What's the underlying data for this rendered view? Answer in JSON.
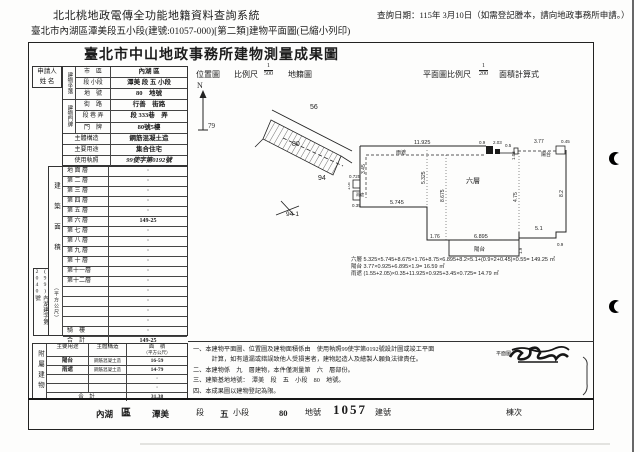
{
  "app": {
    "system_title": "北北桃地政電傳全功能地籍資料查詢系統",
    "query_date": "查詢日期：115年 3月10日（如需登記謄本，請向地政事務所申請。）",
    "subtitle": "臺北市內湖區潭美段五小段(建號:01057-000)[第二類]建物平面圖(已縮小列印)"
  },
  "doc": {
    "title": "臺北市中山地政事務所建物測量成果圖"
  },
  "form": {
    "applicant_line1": "申請人",
    "applicant_line2": "姓 名",
    "section_location": "建物坐落",
    "section_address": "建物門牌",
    "top_rows": [
      {
        "label": "市　區",
        "value": "內湖 區"
      },
      {
        "label": "段 小段",
        "value": "潭美 段 五 小段"
      },
      {
        "label": "地　號",
        "value": "80　地號"
      },
      {
        "label": "街　路",
        "value": "行善　街路"
      },
      {
        "label": "段 巷 弄",
        "value": "段 333巷　弄"
      },
      {
        "label": "門　牌",
        "value": "80號5樓"
      },
      {
        "label": "主體構造",
        "value": "鋼筋混凝土造"
      },
      {
        "label": "主要用途",
        "value": "集合住宅"
      },
      {
        "label": "使用執照",
        "value": "99使字第0192號"
      }
    ],
    "floor_area": {
      "side_label": "建築面積",
      "unit_label": "（平方公尺）",
      "rows": [
        {
          "label": "地 面 層",
          "value": "·"
        },
        {
          "label": "第 二 層",
          "value": "·"
        },
        {
          "label": "第 三 層",
          "value": "·"
        },
        {
          "label": "第 四 層",
          "value": "·"
        },
        {
          "label": "第 五 層",
          "value": "·"
        },
        {
          "label": "第 六 層",
          "value": "149-25"
        },
        {
          "label": "第 七 層",
          "value": "·"
        },
        {
          "label": "第 八 層",
          "value": "·"
        },
        {
          "label": "第 九 層",
          "value": "·"
        },
        {
          "label": "第 十 層",
          "value": "·"
        },
        {
          "label": "第十一層",
          "value": "·"
        },
        {
          "label": "第十二層",
          "value": "·"
        },
        {
          "label": "",
          "value": "·"
        },
        {
          "label": "",
          "value": "·"
        },
        {
          "label": "",
          "value": "·"
        },
        {
          "label": "",
          "value": "·"
        },
        {
          "label": "騎　樓",
          "value": "·"
        },
        {
          "label": "合　計",
          "value": "149-25"
        }
      ],
      "case_no": "(99)內湖建字第2040號"
    },
    "annex": {
      "side_label": "附屬建物",
      "h_use": "主要用途",
      "h_struct": "主體構造",
      "h_area1": "面　積",
      "h_area2": "（平方公尺）",
      "rows": [
        {
          "use": "陽台",
          "struct": "鋼筋混凝土造",
          "area": "16-59"
        },
        {
          "use": "雨遮",
          "struct": "鋼筋混凝土造",
          "area": "14-79"
        },
        {
          "use": "",
          "struct": "",
          "area": "·"
        },
        {
          "use": "",
          "struct": "",
          "area": "·"
        }
      ],
      "total_label": "合　計",
      "total_value": "31.38"
    }
  },
  "map": {
    "title": "位置圖",
    "scale_label": "比例尺",
    "scale_num": "1",
    "scale_den": "500",
    "name": "地籍圖",
    "north": "N",
    "labels": {
      "p79": "79",
      "p56": "56",
      "p80": "80",
      "p94": "94",
      "p941": "94-1"
    }
  },
  "plan": {
    "title": "平面圖比例尺",
    "scale_num": "1",
    "scale_den": "200",
    "calc_label": "面積計算式",
    "floor_label": "六層",
    "canopy_top": "雨遮",
    "canopy_left": "雨遮",
    "balcony_top": "陽台",
    "balcony_bottom": "陽台",
    "dims": {
      "d_top": "11.925",
      "d_09": "0.9",
      "d_203": "2.03",
      "d_05": "0.5",
      "d_105a": "1.05",
      "d_377": "3.77",
      "d_045": "0.45",
      "d_345": "3.45",
      "d_0725": "0.725",
      "d_105b": "1.05",
      "d_035": "0.35",
      "d_5745": "5.745",
      "d_5325": "5.325",
      "d_8675": "8.675",
      "d_475": "4.75",
      "d_82": "8.2",
      "d_176": "1.76",
      "d_6895": "6.895",
      "d_19": "1.9",
      "d_51": "5.1",
      "d_09b": "0.9"
    },
    "formulas": [
      "六層 5.325×5.745+8.675×1.76+8.75×6.895+8.2×5.1+(0.9×2+0.45)×0.55=  149.25  ㎡",
      "陽台 3.77×0.925+6.895×1.9=  16.59  ㎡",
      "雨遮 (1.55+2.05)×0.35+11.925×0.925+3.45×0.725=  14.79  ㎡"
    ]
  },
  "notes": {
    "lines": [
      "一、本建物平面圖、位置圖及建物面積係由　使用執照99使字第0192號設計圖或竣工平面",
      "　　　計算，如有遺漏或錯誤致他人受損害者，建物起造人及繪製人願負法律責任。",
      "二、本建物係　九　層建物，本件僅測量第　六　層部份。",
      "三、建築基地地號：　潭美　段　五　小段　80　地號。",
      "四、本成果圖以建物登記為限。"
    ]
  },
  "footer": {
    "v_district": "內湖",
    "l_district": "區",
    "v_section": "潭美",
    "l_section": "段",
    "v_sub": "五",
    "l_sub": "小段",
    "v_lot": "80",
    "l_lot": "地號",
    "v_bldg": "1057",
    "l_bldg": "建號",
    "l_unit": "棟次"
  },
  "stamp": {
    "label": "平面圖"
  }
}
